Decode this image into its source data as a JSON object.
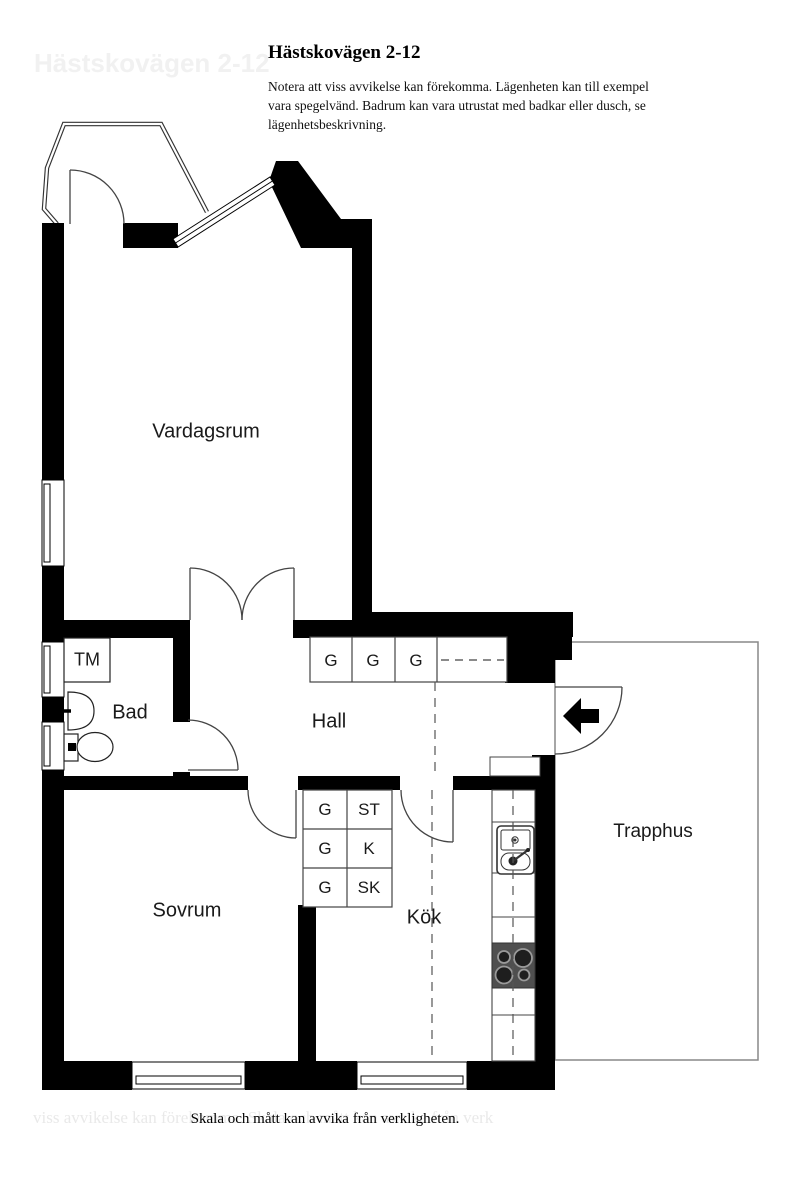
{
  "header": {
    "title": "Hästskovägen 2-12",
    "disclaimer_lines": [
      "Notera att viss avvikelse kan förekomma. Lägenheten kan till exempel",
      "vara spegelvänd. Badrum kan vara utrustat med badkar eller dusch, se",
      "lägenhetsbeskrivning."
    ]
  },
  "footer": {
    "text": "Skala och mått kan avvika från verkligheten."
  },
  "ghosts": {
    "top": "Hästskovägen 2-12",
    "bottom": "viss avvikelse kan förekomma. Skala och mått kan avvika från verk"
  },
  "rooms": {
    "vardagsrum": "Vardagsrum",
    "bad": "Bad",
    "hall": "Hall",
    "sovrum": "Sovrum",
    "kok": "Kök",
    "trapphus": "Trapphus"
  },
  "fixtures": {
    "washing_machine": "TM"
  },
  "closets": {
    "hall_units": [
      "G",
      "G",
      "G"
    ],
    "block": [
      [
        "G",
        "ST"
      ],
      [
        "G",
        "K"
      ],
      [
        "G",
        "SK"
      ]
    ]
  },
  "colors": {
    "wall": "#000000",
    "thin_line": "#444444",
    "trapphus_outline": "#888888",
    "stove_body": "#4f4f4f"
  }
}
